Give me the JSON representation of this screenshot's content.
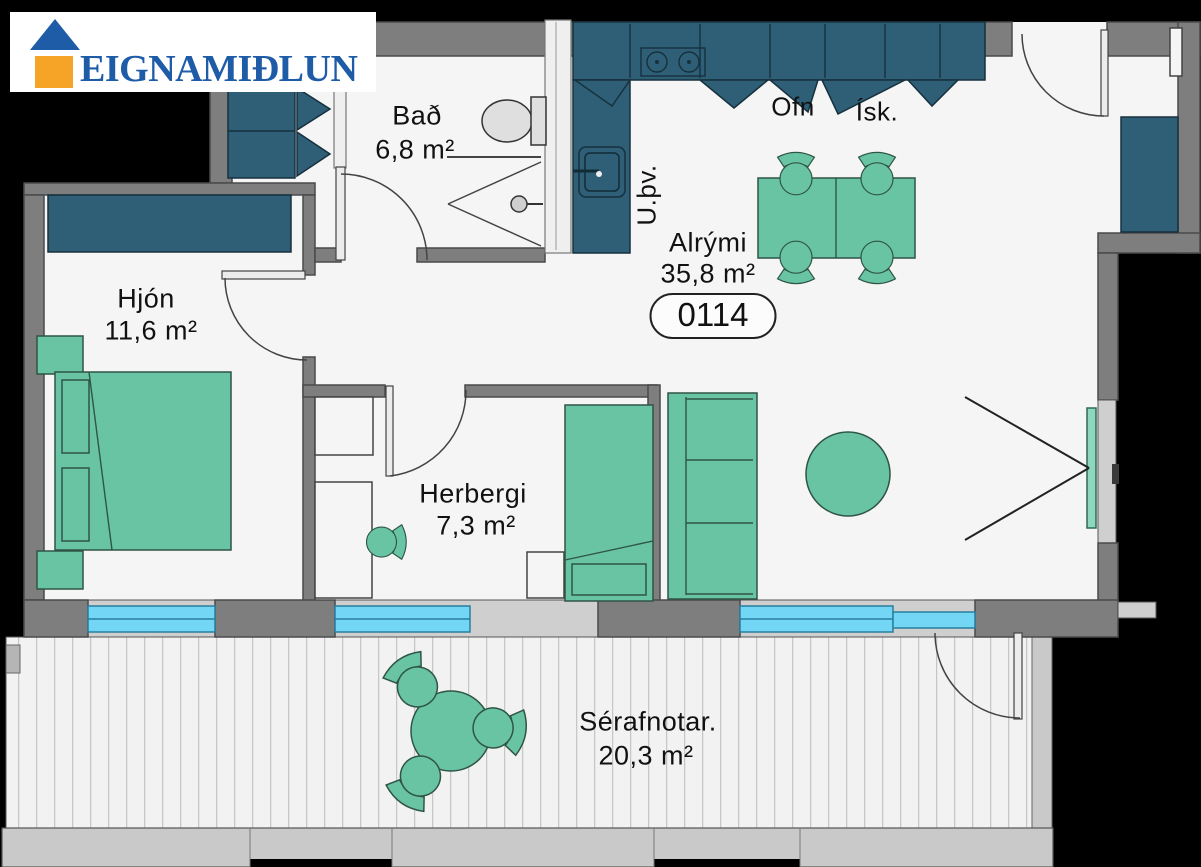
{
  "brand": {
    "name": "EIGNAMIÐLUN"
  },
  "unit": {
    "number": "0114"
  },
  "rooms": {
    "bathroom": {
      "name": "Bað",
      "area": "6,8 m²"
    },
    "bedroom": {
      "name": "Hjón",
      "area": "11,6 m²"
    },
    "living": {
      "name": "Alrými",
      "area": "35,8 m²"
    },
    "bedroom2": {
      "name": "Herbergi",
      "area": "7,3 m²"
    },
    "balcony": {
      "name": "Sérafnotar.",
      "area": "20,3 m²"
    }
  },
  "appliances": {
    "oven": "Ofn",
    "fridge": "Ísk.",
    "washing_machine": "U.þv."
  },
  "colors": {
    "furniture_green": "#69C4A3",
    "cabinet_teal": "#2E5F76",
    "wall_gray": "#7E7E7E",
    "window_blue": "#72D6F4",
    "glass_green": "#8CD7BD",
    "logo_blue": "#1E5CA8",
    "logo_orange": "#F5A428"
  }
}
